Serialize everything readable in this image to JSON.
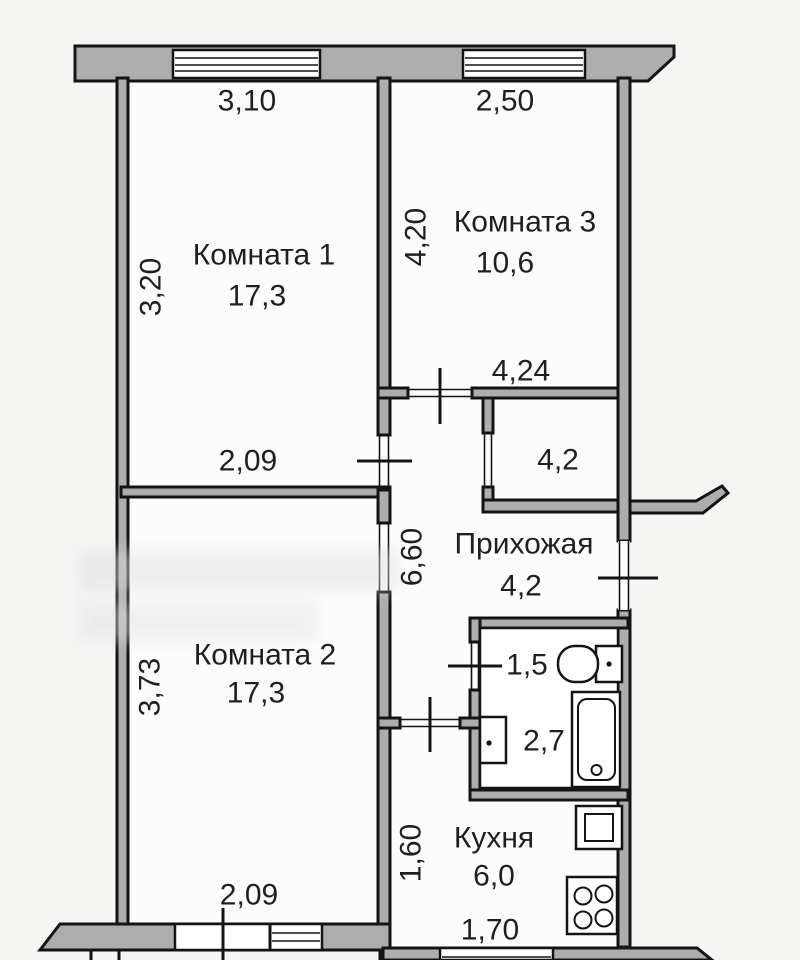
{
  "plan": {
    "room1": {
      "label": "Комната 1",
      "area": "17,3",
      "width_top": "3,10",
      "depth_left": "3,20",
      "door_width": "2,09"
    },
    "room3": {
      "label": "Комната 3",
      "area": "10,6",
      "width_top": "2,50",
      "depth_left": "4,20",
      "width_bottom": "4,24"
    },
    "room2": {
      "label": "Комната 2",
      "area": "17,3",
      "depth_left": "3,73",
      "window_width": "2,09"
    },
    "hallway": {
      "label": "Прихожая",
      "area": "4,2",
      "length_left": "6,60"
    },
    "storage": {
      "area": "4,2"
    },
    "wc": {
      "area": "1,5"
    },
    "bathroom": {
      "area": "2,7"
    },
    "kitchen": {
      "label": "Кухня",
      "area": "6,0",
      "depth_left": "1,60",
      "width_bottom": "1,70"
    }
  },
  "colors": {
    "wall_fill": "#adadad",
    "outline": "#141414",
    "background": "#f5f5f4",
    "floor": "#fcfcfc",
    "text": "#1f1f1f"
  }
}
